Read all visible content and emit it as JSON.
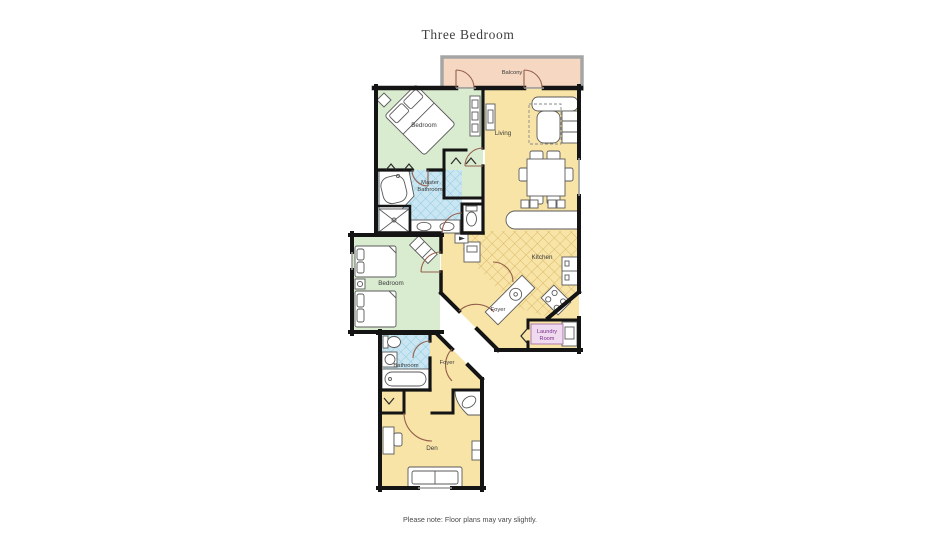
{
  "title": "Three Bedroom",
  "note": "Please note: Floor plans may vary slightly.",
  "rooms": {
    "balcony": "Balcony",
    "bedroom_top": "Bedroom",
    "living": "Living",
    "master_bath_1": "Master",
    "master_bath_2": "Bathroom",
    "bedroom_mid": "Bedroom",
    "kitchen": "Kitchen",
    "foyer_upper": "Foyer",
    "laundry_1": "Laundry",
    "laundry_2": "Room",
    "bathroom": "Bathroom",
    "foyer_lower": "Foyer",
    "den": "Den"
  },
  "colors": {
    "bedroom_green": "#d9ecd0",
    "living_yellow": "#f8e4a6",
    "kitchen_hatch": "#d8b565",
    "bath_blue": "#c9e6f2",
    "bath_hatch": "#88c4dd",
    "balcony_peach": "#f6d8c2",
    "balcony_rail": "#a5a5a5",
    "laundry_bg": "#efdaf0",
    "laundry_text": "#7c2f88",
    "door_arc": "#95604c",
    "wall": "#141414",
    "label_text": "#3a3a3a"
  }
}
